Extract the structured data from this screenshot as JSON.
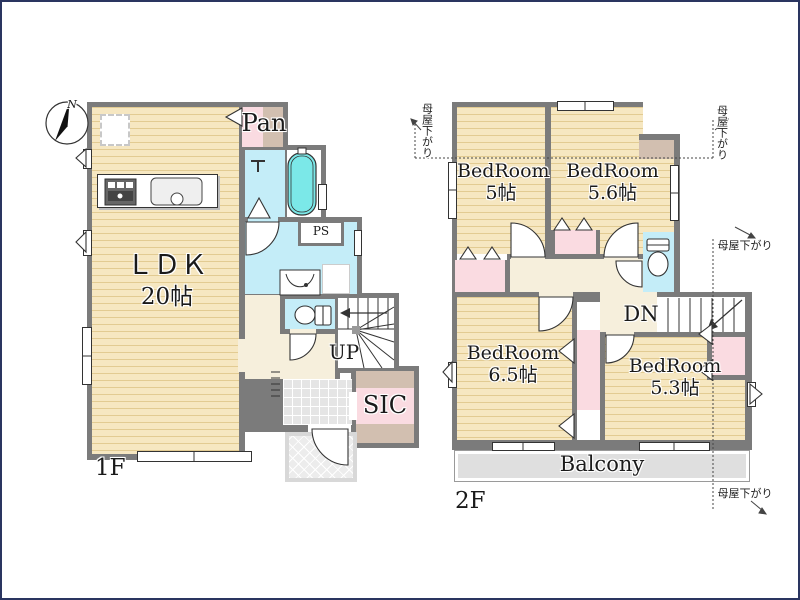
{
  "compass": {
    "north_label": "N"
  },
  "colors": {
    "wall": "#7b7b7b",
    "floor": "#f6e7c1",
    "floor_stripe": "#e2cb92",
    "closet_pink": "#fadbe1",
    "closet_tan": "#d2bfb0",
    "wet_area_blue": "#c4edf8",
    "hall_cream": "#f6efdc",
    "bathtub_cyan": "#7be8e8",
    "balcony_gray": "#dfdfdf",
    "entry_tile_gray": "#e5e5e5"
  },
  "floor1": {
    "label": "1F",
    "ldk_name": "ＬＤＫ",
    "ldk_size": "20帖",
    "pantry_label": "Pan",
    "pipe_space_label": "PS",
    "stairs_up_label": "UP",
    "shoe_closet_label": "SIC"
  },
  "floor2": {
    "label": "2F",
    "bedroom_a_name": "BedRoom",
    "bedroom_a_size": "5帖",
    "bedroom_b_name": "BedRoom",
    "bedroom_b_size": "5.6帖",
    "bedroom_c_name": "BedRoom",
    "bedroom_c_size": "6.5帖",
    "bedroom_d_name": "BedRoom",
    "bedroom_d_size": "5.3帖",
    "stairs_down_label": "DN",
    "balcony_label": "Balcony",
    "roof_slope_note": "母屋下がり"
  }
}
